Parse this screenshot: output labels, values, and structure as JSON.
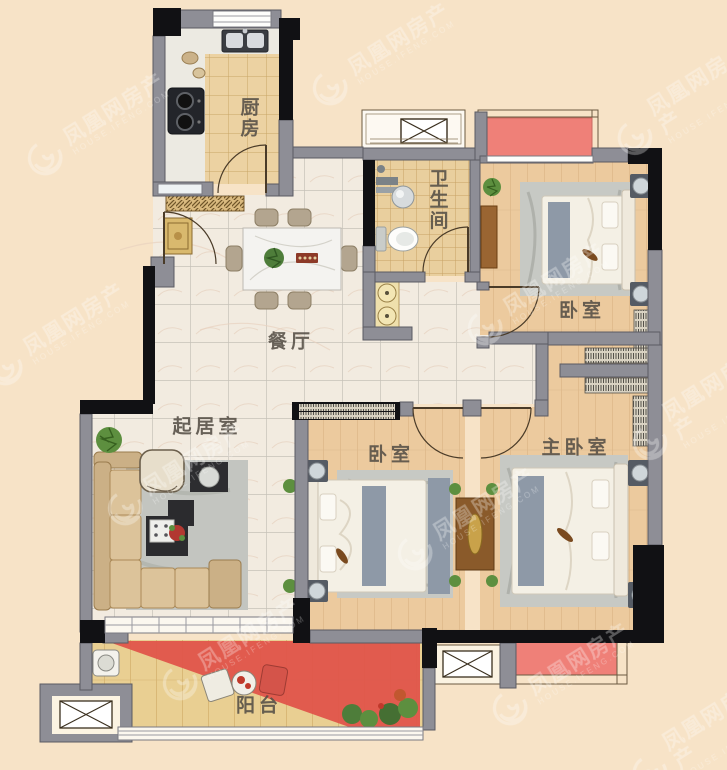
{
  "watermark": {
    "brand": "凤凰网房产",
    "domain": "HOUSE.IFENG.COM"
  },
  "rooms": [
    {
      "id": "kitchen",
      "label": "厨房"
    },
    {
      "id": "bathroom",
      "label": "卫生间"
    },
    {
      "id": "bedroom-north",
      "label": "卧室"
    },
    {
      "id": "dining",
      "label": "餐厅"
    },
    {
      "id": "living",
      "label": "起居室"
    },
    {
      "id": "bedroom-middle",
      "label": "卧室"
    },
    {
      "id": "master-bedroom",
      "label": "主卧室"
    },
    {
      "id": "balcony",
      "label": "阳台"
    }
  ],
  "colors": {
    "background": "#f7e3c7",
    "wall": "#8e8e96",
    "wall_dark": "#111114",
    "red_accent": "#e0564b",
    "flower_bed": "#ef8078",
    "wood_floor": "#ecca9e",
    "marble_floor": "#f2ebe0",
    "tile_floor": "#ecd2a2",
    "label_text": "#554f46"
  }
}
